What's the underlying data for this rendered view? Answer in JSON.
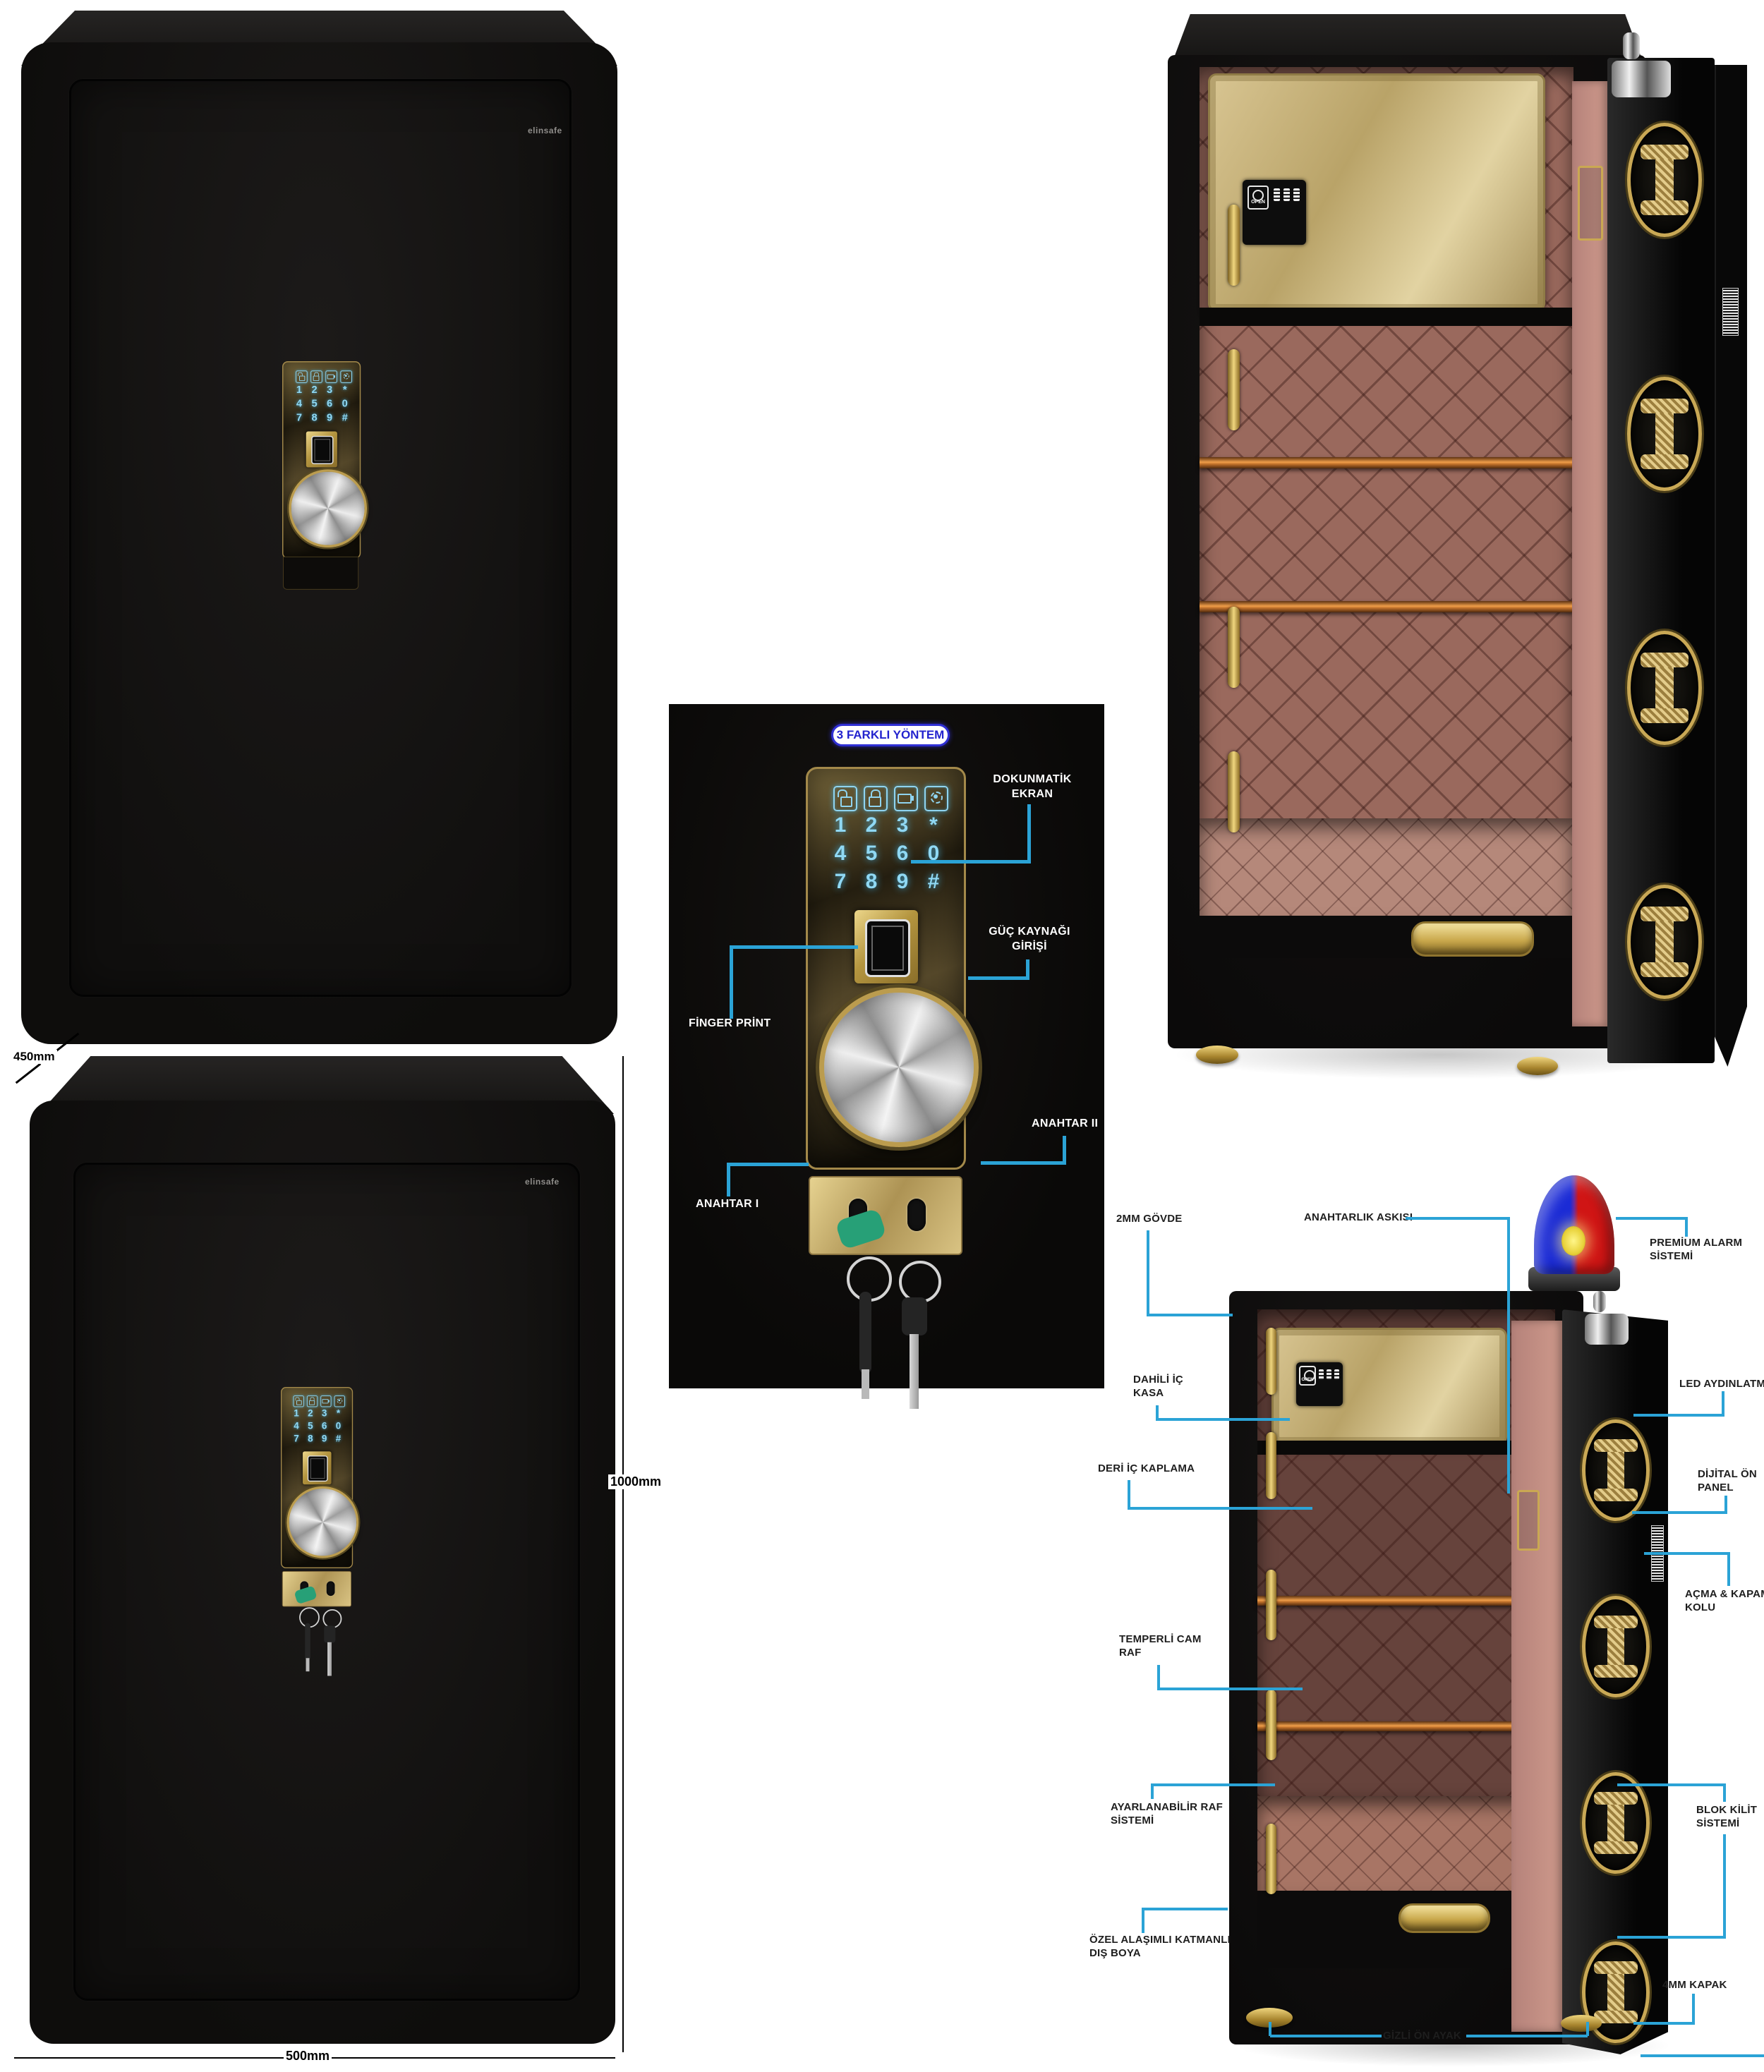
{
  "brand": {
    "logo_text": "elinsafe"
  },
  "dimensions": {
    "depth": "450mm",
    "height": "1000mm",
    "width": "500mm"
  },
  "method_panel": {
    "header": "3 FARKLI YÖNTEM",
    "status_icons": [
      "unlock-icon",
      "lock-icon",
      "battery-low-icon",
      "settings-gear-icon"
    ],
    "keys": [
      "1",
      "2",
      "3",
      "*",
      "4",
      "5",
      "6",
      "0",
      "7",
      "8",
      "9",
      "#"
    ],
    "callouts": {
      "touch_screen": [
        "DOKUNMATİK",
        "EKRAN"
      ],
      "power_input": [
        "GÜÇ KAYNAĞI",
        "GİRİŞİ"
      ],
      "key_2": "ANAHTAR II",
      "finger_print": "FİNGER PRİNT",
      "key_1": "ANAHTAR I"
    }
  },
  "inner_safe": {
    "open_label": "OPEN"
  },
  "feature_diagram": {
    "left": [
      {
        "id": "body-2mm",
        "lines": [
          "2MM GÖVDE"
        ]
      },
      {
        "id": "inner-safe",
        "lines": [
          "DAHİLİ İÇ",
          "KASA"
        ]
      },
      {
        "id": "leather-lining",
        "lines": [
          "DERİ İÇ KAPLAMA"
        ]
      },
      {
        "id": "tempered-glass-shelf",
        "lines": [
          "TEMPERLİ CAM",
          "RAF"
        ]
      },
      {
        "id": "adjustable-shelf",
        "lines": [
          "AYARLANABİLİR RAF",
          "SİSTEMİ"
        ]
      },
      {
        "id": "alloy-paint",
        "lines": [
          "ÖZEL ALAŞIMLI KATMANLI",
          "DIŞ BOYA"
        ]
      }
    ],
    "top": {
      "keyring_hook": "ANAHTARLIK ASKISI"
    },
    "right": [
      {
        "id": "premium-alarm",
        "lines": [
          "PREMİUM ALARM",
          "SİSTEMİ"
        ]
      },
      {
        "id": "led-lighting",
        "lines": [
          "LED AYDINLATMA"
        ]
      },
      {
        "id": "digital-front-panel",
        "lines": [
          "DİJİTAL ÖN",
          "PANEL"
        ]
      },
      {
        "id": "open-close-handle",
        "lines": [
          "AÇMA & KAPAMA",
          "KOLU"
        ]
      },
      {
        "id": "block-lock-system",
        "lines": [
          "BLOK KİLİT",
          "SİSTEMİ"
        ]
      },
      {
        "id": "door-4mm",
        "lines": [
          "4MM KAPAK"
        ]
      }
    ],
    "bottom": {
      "hidden_front_foot": "GİZLİ ÖN AYAK"
    }
  },
  "colors": {
    "callout_line": "#2BA3D6",
    "header_text": "#2323CE",
    "gold": "#C9A855",
    "keypad_glow": "#8FD8F4",
    "interior_pink": "#B5827A",
    "alarm_blue": "#1B2BD6",
    "alarm_red": "#D01515"
  }
}
